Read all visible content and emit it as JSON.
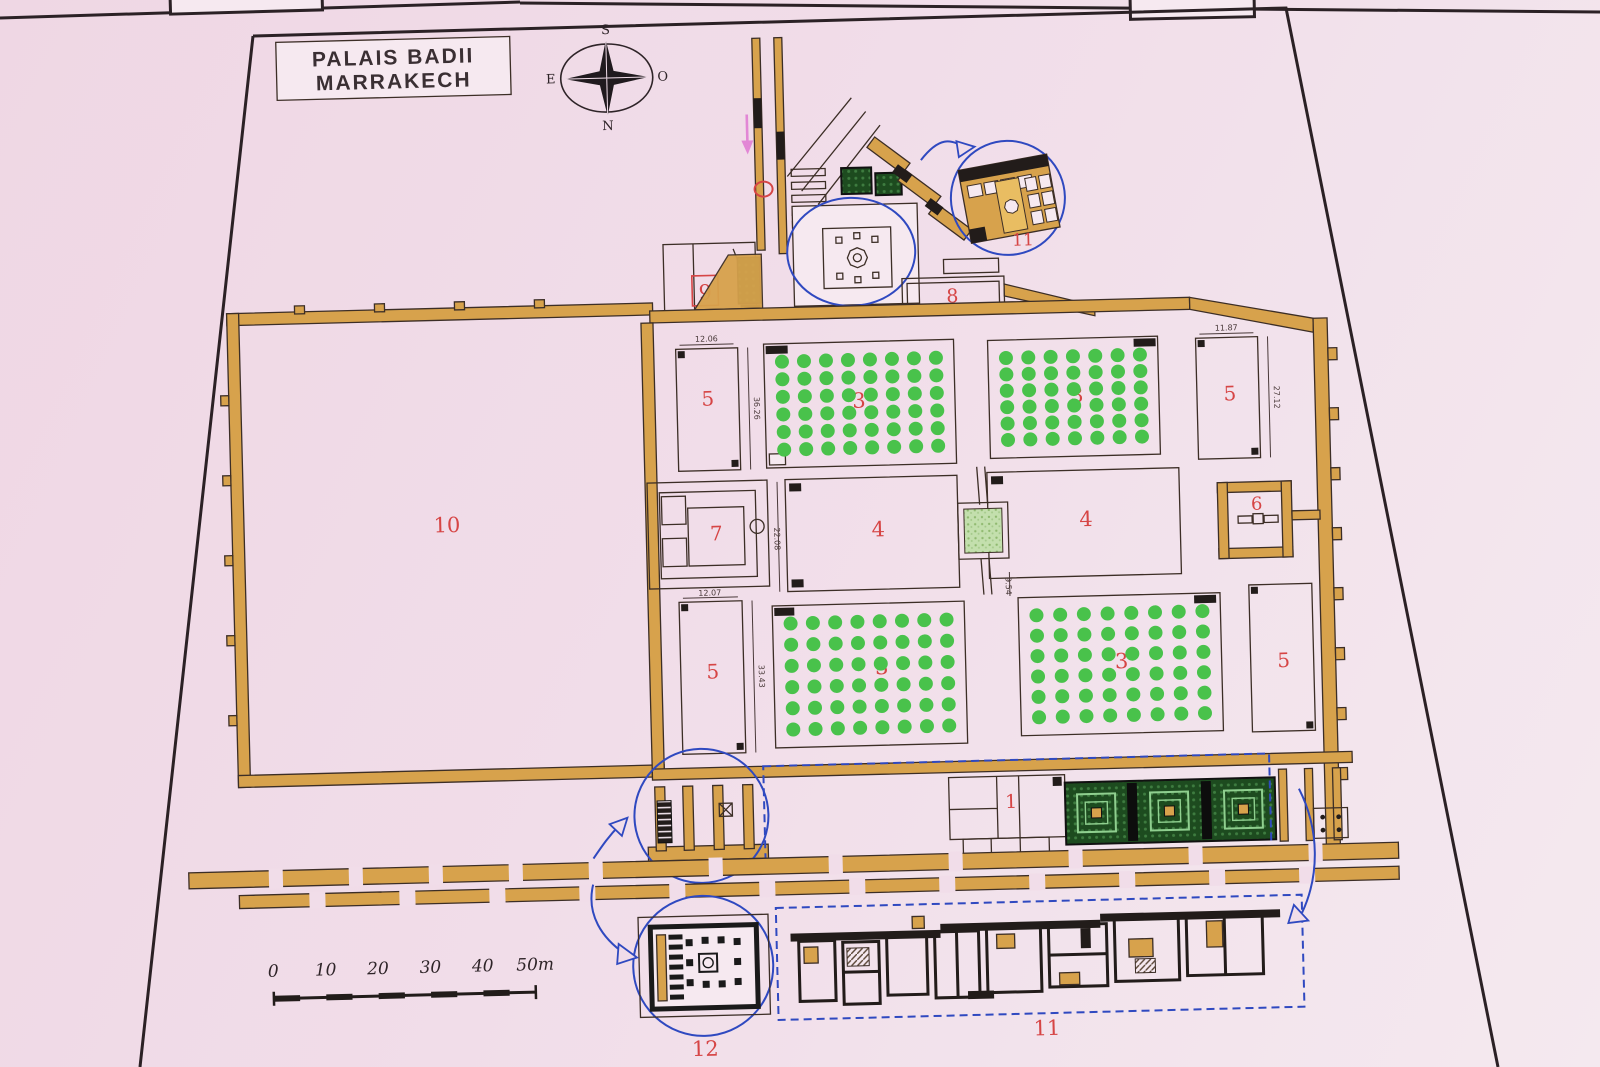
{
  "title": {
    "line1": "PALAIS BADII",
    "line2": "MARRAKECH"
  },
  "compass": {
    "top": "S",
    "bottom": "N",
    "left": "E",
    "right": "O"
  },
  "labels": {
    "area1": "1",
    "area3_nw": "3",
    "area3_ne": "3",
    "area3_sw": "3",
    "area3_se": "3",
    "area4_w": "4",
    "area4_e": "4",
    "area5_nw": "5",
    "area5_ne": "5",
    "area5_sw": "5",
    "area5_se": "5",
    "area6": "6",
    "area7": "7",
    "area8": "8",
    "area9": "9",
    "area10": "10",
    "area11_inset": "11",
    "area11_detail": "11",
    "area12": "12"
  },
  "dimensions": {
    "basin_nw_width": "12.06",
    "basin_nw_length": "36.26",
    "basin_ne_width": "11.87",
    "basin_ne_length": "27.12",
    "basin_sw_width": "12.07",
    "basin_sw_length": "33.43",
    "pool_width": "22.08",
    "pool_channel": "9.54"
  },
  "scale_bar": {
    "ticks": [
      "0",
      "10",
      "20",
      "30",
      "40"
    ],
    "end_label": "50m"
  },
  "orchards": {
    "nw": {
      "cols": 8,
      "rows": 6
    },
    "ne": {
      "cols": 7,
      "rows": 6
    },
    "sw": {
      "cols": 8,
      "rows": 6
    },
    "se": {
      "cols": 8,
      "rows": 6
    }
  },
  "colors": {
    "background": "#f1dde9",
    "wall_tan": "#d7a24c",
    "line_dark": "#3c2e26",
    "tree_green": "#49c24b",
    "garden_dark": "#1d4b1f",
    "label_red": "#d64545",
    "callout_blue": "#2f49c0",
    "entrance_arrow_pink": "#e287d5",
    "fountain_green": "#c3dfad"
  }
}
